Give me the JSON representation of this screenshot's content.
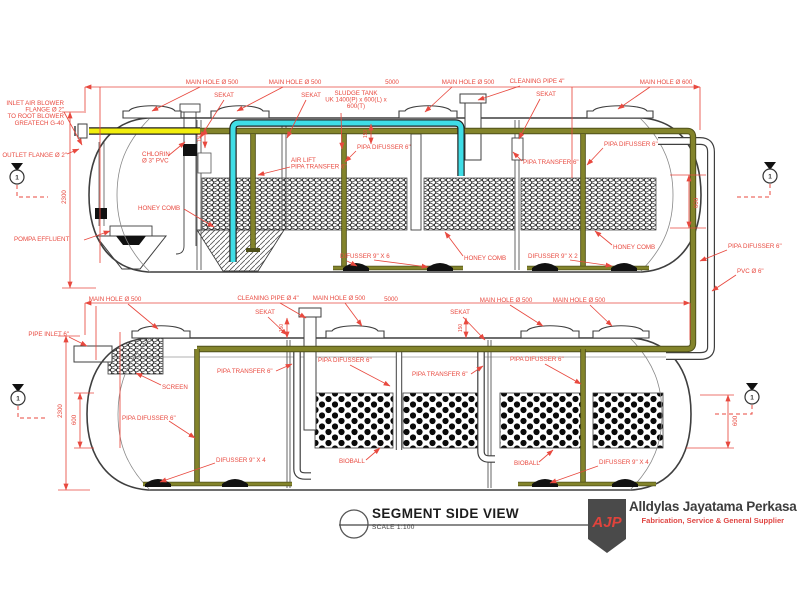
{
  "colors": {
    "annotation": "#e8493f",
    "pipe_olive": "#83842b",
    "pipe_olive_dark": "#4f501a",
    "pipe_cyan": "#3fdde6",
    "pipe_yellow": "#f2ee0e",
    "outline": "#3f3f3f",
    "logo_shield": "#4a4a4a",
    "logo_red": "#e04643"
  },
  "title_block": {
    "title": "SEGMENT SIDE VIEW",
    "scale": "SCALE 1:100"
  },
  "logo": {
    "abbr": "AJP",
    "company": "Alldylas Jayatama Perkasa",
    "tagline": "Fabrication, Service & General Supplier"
  },
  "diagram": {
    "annotations": [
      {
        "text": "MAIN HOLE Ø 500",
        "x": 212,
        "y": 84,
        "align": "center",
        "leaders": [
          [
            200,
            87,
            152,
            111
          ]
        ]
      },
      {
        "text": "MAIN HOLE Ø 500",
        "x": 295,
        "y": 84,
        "align": "center",
        "leaders": [
          [
            283,
            87,
            237,
            111
          ]
        ]
      },
      {
        "text": "5000",
        "x": 392,
        "y": 84,
        "align": "center"
      },
      {
        "text": "MAIN HOLE Ø 500",
        "x": 468,
        "y": 84,
        "align": "center",
        "leaders": [
          [
            452,
            87,
            425,
            112
          ]
        ]
      },
      {
        "text": "CLEANING PIPE 4\"",
        "x": 537,
        "y": 83,
        "align": "center",
        "leaders": [
          [
            520,
            86,
            478,
            100
          ]
        ]
      },
      {
        "text": "MAIN HOLE Ø 600",
        "x": 666,
        "y": 84,
        "align": "center",
        "leaders": [
          [
            650,
            87,
            618,
            109
          ]
        ]
      },
      {
        "text": "SEKAT",
        "x": 224,
        "y": 97,
        "align": "center",
        "leaders": [
          [
            224,
            100,
            200,
            138
          ]
        ]
      },
      {
        "text": "SEKAT",
        "x": 311,
        "y": 97,
        "align": "center",
        "leaders": [
          [
            306,
            100,
            287,
            138
          ]
        ]
      },
      {
        "text": [
          "SLUDGE TANK",
          "UK 1400(P) x 600(L) x",
          "600(T)"
        ],
        "x": 356,
        "y": 95,
        "align": "center",
        "leaders": [
          [
            341,
            113,
            342,
            149
          ]
        ]
      },
      {
        "text": "SEKAT",
        "x": 546,
        "y": 96,
        "align": "center",
        "leaders": [
          [
            540,
            99,
            519,
            139
          ]
        ]
      },
      {
        "text": [
          "INLET AIR BLOWER",
          "FLANGE Ø 2\"",
          "TO ROOT BLOWER",
          "GREATECH G-40"
        ],
        "x": 64,
        "y": 105,
        "align": "right",
        "leaders": [
          [
            64,
            112,
            82,
            145
          ]
        ]
      },
      {
        "text": "OUTLET FLANGE Ø 2\"",
        "x": 67,
        "y": 157,
        "align": "right",
        "leaders": [
          [
            67,
            154,
            79,
            149
          ]
        ]
      },
      {
        "text": [
          "CHLORIN",
          "Ø 3\" PVC"
        ],
        "x": 142,
        "y": 156,
        "align": "left",
        "leaders": [
          [
            168,
            156,
            185,
            142
          ]
        ]
      },
      {
        "text": [
          "AIR LIFT",
          "PIPA TRANSFER 6\""
        ],
        "x": 291,
        "y": 162,
        "align": "left",
        "leaders": [
          [
            290,
            167,
            258,
            175
          ]
        ]
      },
      {
        "text": "PIPA DIFUSSER 6\"",
        "x": 357,
        "y": 149,
        "align": "left",
        "leaders": [
          [
            356,
            151,
            345,
            162
          ]
        ]
      },
      {
        "text": "PIPA DIFUSSER 6\"",
        "x": 604,
        "y": 146,
        "align": "left",
        "leaders": [
          [
            603,
            148,
            587,
            165
          ]
        ]
      },
      {
        "text": "PIPA TRANSFER 6\"",
        "x": 523,
        "y": 164,
        "align": "left",
        "leaders": [
          [
            522,
            161,
            513,
            152
          ]
        ]
      },
      {
        "text": "HONEY COMB",
        "x": 138,
        "y": 210,
        "align": "left",
        "leaders": [
          [
            184,
            209,
            214,
            227
          ]
        ]
      },
      {
        "text": "HONEY COMB",
        "x": 464,
        "y": 260,
        "align": "left",
        "leaders": [
          [
            463,
            256,
            445,
            232
          ]
        ]
      },
      {
        "text": "HONEY COMB",
        "x": 613,
        "y": 249,
        "align": "left",
        "leaders": [
          [
            612,
            245,
            595,
            231
          ]
        ]
      },
      {
        "text": "DIFUSSER 9\" X 6",
        "x": 340,
        "y": 258,
        "align": "left",
        "leaders": [
          [
            374,
            260,
            428,
            267
          ],
          [
            347,
            261,
            357,
            266
          ]
        ]
      },
      {
        "text": "DIFUSSER 9\" X 2",
        "x": 528,
        "y": 258,
        "align": "left",
        "leaders": [
          [
            570,
            260,
            612,
            266
          ]
        ]
      },
      {
        "text": "POMPA EFFLUENT",
        "x": 14,
        "y": 241,
        "align": "left",
        "leaders": [
          [
            84,
            240,
            110,
            231
          ]
        ]
      },
      {
        "text": "PIPA DIFUSSER 6\"",
        "x": 728,
        "y": 248,
        "align": "left",
        "leaders": [
          [
            727,
            250,
            700,
            261
          ]
        ]
      },
      {
        "text": "PVC Ø 6\"",
        "x": 737,
        "y": 273,
        "align": "left",
        "leaders": [
          [
            736,
            275,
            712,
            291
          ]
        ]
      },
      {
        "text": "2300",
        "x": 66,
        "y": 197,
        "align": "center",
        "rotate": -90
      },
      {
        "text": "600",
        "x": 698,
        "y": 203,
        "align": "center",
        "rotate": -90
      },
      {
        "text": "150",
        "x": 201,
        "y": 138,
        "align": "center",
        "rotate": -90,
        "size": 5
      },
      {
        "text": "150",
        "x": 367,
        "y": 134,
        "align": "center",
        "rotate": -90,
        "size": 5
      },
      {
        "text": "MAIN HOLE Ø 500",
        "x": 115,
        "y": 301,
        "align": "center",
        "leaders": [
          [
            128,
            304,
            158,
            329
          ]
        ]
      },
      {
        "text": "CLEANING PIPE Ø 4\"",
        "x": 268,
        "y": 300,
        "align": "center",
        "leaders": [
          [
            280,
            303,
            306,
            318
          ]
        ]
      },
      {
        "text": "MAIN HOLE Ø 500",
        "x": 339,
        "y": 300,
        "align": "center",
        "leaders": [
          [
            345,
            303,
            362,
            326
          ]
        ]
      },
      {
        "text": "5000",
        "x": 391,
        "y": 301,
        "align": "center"
      },
      {
        "text": "MAIN HOLE Ø 500",
        "x": 506,
        "y": 302,
        "align": "center",
        "leaders": [
          [
            510,
            305,
            543,
            326
          ]
        ]
      },
      {
        "text": "MAIN HOLE Ø 500",
        "x": 579,
        "y": 302,
        "align": "center",
        "leaders": [
          [
            590,
            305,
            612,
            326
          ]
        ]
      },
      {
        "text": "SEKAT",
        "x": 265,
        "y": 314,
        "align": "center",
        "leaders": [
          [
            268,
            317,
            287,
            335
          ]
        ]
      },
      {
        "text": "SEKAT",
        "x": 460,
        "y": 314,
        "align": "center",
        "leaders": [
          [
            463,
            317,
            485,
            340
          ]
        ]
      },
      {
        "text": "PIPE INLET 6\"",
        "x": 69,
        "y": 336,
        "align": "right",
        "leaders": [
          [
            69,
            337,
            87,
            346
          ]
        ]
      },
      {
        "text": "SCREEN",
        "x": 162,
        "y": 389,
        "align": "left",
        "leaders": [
          [
            161,
            385,
            136,
            373
          ]
        ]
      },
      {
        "text": "PIPA TRANSFER 6\"",
        "x": 217,
        "y": 373,
        "align": "left",
        "leaders": [
          [
            276,
            371,
            292,
            364
          ]
        ]
      },
      {
        "text": "PIPA TRANSFER 6\"",
        "x": 412,
        "y": 376,
        "align": "left",
        "leaders": [
          [
            471,
            374,
            483,
            366
          ]
        ]
      },
      {
        "text": "PIPA DIFUSSER 6\"",
        "x": 122,
        "y": 420,
        "align": "left",
        "leaders": [
          [
            169,
            421,
            195,
            438
          ]
        ]
      },
      {
        "text": "PIPA DIFUSSER 6\"",
        "x": 318,
        "y": 362,
        "align": "left",
        "leaders": [
          [
            350,
            365,
            390,
            386
          ]
        ]
      },
      {
        "text": "PIPA DIFUSSER 6\"",
        "x": 510,
        "y": 361,
        "align": "left",
        "leaders": [
          [
            545,
            364,
            581,
            384
          ]
        ]
      },
      {
        "text": "DIFUSSER 9\" X 4",
        "x": 216,
        "y": 462,
        "align": "left",
        "leaders": [
          [
            215,
            463,
            160,
            482
          ]
        ]
      },
      {
        "text": "BIOBALL",
        "x": 339,
        "y": 463,
        "align": "left",
        "leaders": [
          [
            366,
            460,
            380,
            448
          ]
        ]
      },
      {
        "text": "BIOBALL",
        "x": 514,
        "y": 465,
        "align": "left",
        "leaders": [
          [
            539,
            462,
            553,
            450
          ]
        ]
      },
      {
        "text": "DIFUSSER 9\" X 4",
        "x": 599,
        "y": 464,
        "align": "left",
        "leaders": [
          [
            598,
            466,
            550,
            483
          ]
        ]
      },
      {
        "text": "2300",
        "x": 62,
        "y": 411,
        "align": "center",
        "rotate": -90
      },
      {
        "text": "600",
        "x": 76,
        "y": 420,
        "align": "center",
        "rotate": -90
      },
      {
        "text": "600",
        "x": 737,
        "y": 421,
        "align": "center",
        "rotate": -90
      },
      {
        "text": "150",
        "x": 283,
        "y": 328,
        "align": "center",
        "rotate": -90,
        "size": 5
      },
      {
        "text": "150",
        "x": 462,
        "y": 328,
        "align": "center",
        "rotate": -90,
        "size": 5
      }
    ],
    "dimension_lines": [
      [
        85,
        87,
        700,
        87
      ],
      [
        70,
        112,
        70,
        288
      ],
      [
        689,
        175,
        689,
        228
      ],
      [
        205,
        128,
        205,
        148
      ],
      [
        371,
        124,
        371,
        144
      ],
      [
        85,
        303,
        690,
        303
      ],
      [
        66,
        336,
        66,
        490
      ],
      [
        80,
        393,
        80,
        448
      ],
      [
        728,
        395,
        728,
        448
      ],
      [
        287,
        318,
        287,
        338
      ],
      [
        466,
        318,
        466,
        338
      ]
    ],
    "construction_lines": [
      [
        85,
        87,
        85,
        113
      ],
      [
        700,
        87,
        700,
        130
      ],
      [
        572,
        87,
        572,
        178
      ],
      [
        100,
        87,
        100,
        263
      ],
      [
        62,
        112,
        84,
        112
      ],
      [
        62,
        288,
        96,
        288
      ],
      [
        670,
        175,
        706,
        175
      ],
      [
        670,
        228,
        706,
        228
      ],
      [
        85,
        303,
        85,
        335
      ],
      [
        690,
        303,
        690,
        340
      ],
      [
        96,
        306,
        96,
        360
      ],
      [
        120,
        332,
        120,
        448
      ],
      [
        58,
        336,
        80,
        336
      ],
      [
        58,
        490,
        90,
        490
      ],
      [
        74,
        393,
        94,
        393
      ],
      [
        74,
        448,
        94,
        448
      ],
      [
        700,
        395,
        734,
        395
      ],
      [
        686,
        448,
        734,
        448
      ]
    ],
    "section_markers": [
      {
        "label": "1",
        "x": 17,
        "y": 177,
        "dash": [
          [
            17,
            185
          ],
          [
            17,
            197
          ],
          [
            48,
            197
          ]
        ]
      },
      {
        "label": "1",
        "x": 18,
        "y": 398,
        "dash": [
          [
            18,
            406
          ],
          [
            18,
            418
          ],
          [
            48,
            418
          ]
        ]
      },
      {
        "label": "1",
        "x": 770,
        "y": 176,
        "dash": [
          [
            770,
            184
          ],
          [
            770,
            197
          ],
          [
            737,
            197
          ]
        ]
      },
      {
        "label": "1",
        "x": 752,
        "y": 397,
        "dash": [
          [
            752,
            405
          ],
          [
            752,
            414
          ],
          [
            714,
            414
          ]
        ]
      }
    ]
  }
}
